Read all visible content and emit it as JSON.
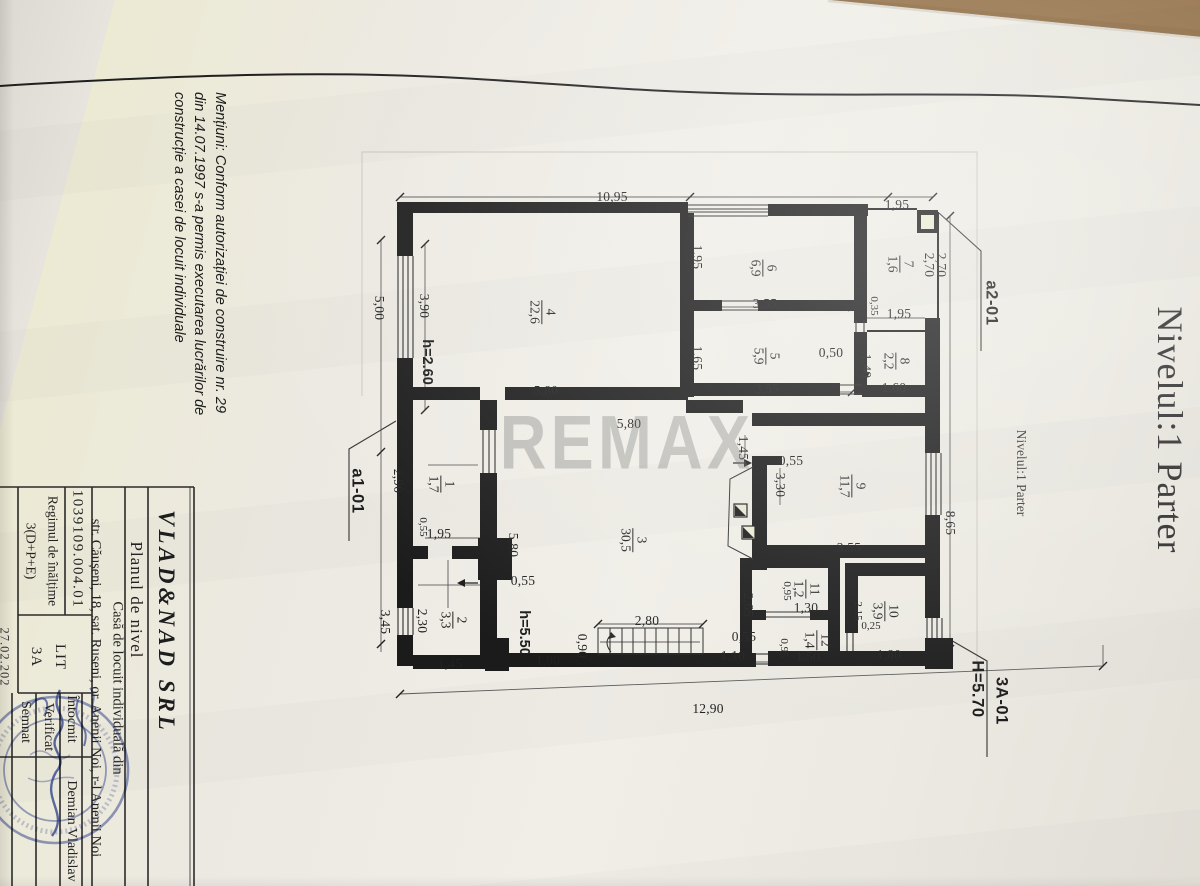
{
  "sheet": {
    "watermark": "REMAX",
    "level_title": "Nivelul:1 Parter",
    "note": "Mențiuni: Conform autorizației de construire nr. 29 din 14.07.1997 s-a permis executarea lucrărilor de construcție a casei de locuit individuale"
  },
  "title_block": {
    "company": "VLAD&NAD SRL",
    "drawing_title": "Planul de nivel",
    "object": "Casă de locuit individuală din str. Căușeni, 18, sat. Ruseni, or. Anenii Noi, r-l Anenii Noi",
    "cadastral_number": "1039109.004.01",
    "height_regime": "Regimul de înălțime 3(D+P+E)",
    "lit": "LIT 3A",
    "rows": [
      {
        "label": "Întocmit",
        "value": "Demian Vladislav"
      },
      {
        "label": "Verificat",
        "value": ""
      },
      {
        "label": "Semnat",
        "value": ""
      }
    ],
    "date_partial": "27.02.202"
  },
  "rooms": [
    {
      "no": "1",
      "area_m2": "1,7"
    },
    {
      "no": "2",
      "area_m2": "3,3"
    },
    {
      "no": "3",
      "area_m2": "30,5"
    },
    {
      "no": "4",
      "area_m2": "22,6"
    },
    {
      "no": "5",
      "area_m2": "5,9"
    },
    {
      "no": "6",
      "area_m2": "6,9"
    },
    {
      "no": "7",
      "area_m2": "1,6"
    },
    {
      "no": "8",
      "area_m2": "2,2"
    },
    {
      "no": "9",
      "area_m2": "11,7"
    },
    {
      "no": "10",
      "area_m2": "3,9"
    },
    {
      "no": "11",
      "area_m2": "1,2"
    },
    {
      "no": "12",
      "area_m2": "1,4"
    }
  ],
  "labels": [
    {
      "name": "dim-top-1095",
      "cls": "dim",
      "rot": "h",
      "x": 612,
      "y": 197,
      "text": "10,95"
    },
    {
      "name": "dim-top-195",
      "cls": "dim",
      "rot": "h",
      "x": 897,
      "y": 205,
      "text": "1,95"
    },
    {
      "name": "dim-270-a",
      "cls": "dim",
      "rot": "v",
      "x": 929,
      "y": 265,
      "text": "2,70"
    },
    {
      "name": "dim-270-b",
      "cls": "dim",
      "rot": "v",
      "x": 941,
      "y": 265,
      "text": "2,70"
    },
    {
      "name": "dim-195-room6",
      "cls": "dim",
      "rot": "v",
      "x": 697,
      "y": 257,
      "text": "1,95"
    },
    {
      "name": "dim-355-room6",
      "cls": "dim",
      "rot": "h",
      "x": 765,
      "y": 304,
      "text": "3,55"
    },
    {
      "name": "dim-035",
      "cls": "dimsm",
      "rot": "v",
      "x": 874,
      "y": 306,
      "text": "0,35"
    },
    {
      "name": "dim-195-room8",
      "cls": "dim",
      "rot": "h",
      "x": 899,
      "y": 314,
      "text": "1,95"
    },
    {
      "name": "dim-165",
      "cls": "dim",
      "rot": "v",
      "x": 697,
      "y": 358,
      "text": "1,65"
    },
    {
      "name": "dim-050",
      "cls": "dim",
      "rot": "h",
      "x": 831,
      "y": 353,
      "text": "0,50"
    },
    {
      "name": "dim-140",
      "cls": "dim",
      "rot": "v",
      "x": 866,
      "y": 366,
      "text": "1,40"
    },
    {
      "name": "dim-160",
      "cls": "dim",
      "rot": "h",
      "x": 894,
      "y": 388,
      "text": "1,60"
    },
    {
      "name": "dim-355-room5",
      "cls": "dim",
      "rot": "h",
      "x": 767,
      "y": 389,
      "text": "3,55"
    },
    {
      "name": "dim-500",
      "cls": "dim",
      "rot": "v",
      "x": 379,
      "y": 308,
      "text": "5,00"
    },
    {
      "name": "dim-390",
      "cls": "dim",
      "rot": "v",
      "x": 424,
      "y": 306,
      "text": "3,90"
    },
    {
      "name": "dim-580-a",
      "cls": "dim",
      "rot": "h",
      "x": 546,
      "y": 391,
      "text": "5,80"
    },
    {
      "name": "dim-580-b",
      "cls": "dim",
      "rot": "h",
      "x": 629,
      "y": 424,
      "text": "5,80"
    },
    {
      "name": "dim-290",
      "cls": "dim",
      "rot": "v",
      "x": 398,
      "y": 481,
      "text": "2,90"
    },
    {
      "name": "dim-145-hall",
      "cls": "dim",
      "rot": "v",
      "x": 743,
      "y": 448,
      "text": "1,45"
    },
    {
      "name": "dim-055-hall",
      "cls": "dim",
      "rot": "h",
      "x": 791,
      "y": 461,
      "text": "0,55"
    },
    {
      "name": "dim-330",
      "cls": "dim",
      "rot": "v",
      "x": 780,
      "y": 485,
      "text": "3,30"
    },
    {
      "name": "dim-865",
      "cls": "dim",
      "rot": "v",
      "x": 950,
      "y": 523,
      "text": "8,65"
    },
    {
      "name": "dim-355-room9",
      "cls": "dim",
      "rot": "h",
      "x": 849,
      "y": 548,
      "text": "3,55"
    },
    {
      "name": "dim-055-room1",
      "cls": "dimsm",
      "rot": "v",
      "x": 423,
      "y": 527,
      "text": "0,55"
    },
    {
      "name": "dim-195-room2",
      "cls": "dim",
      "rot": "h",
      "x": 439,
      "y": 534,
      "text": "1,95"
    },
    {
      "name": "dim-580-c",
      "cls": "dim",
      "rot": "v",
      "x": 513,
      "y": 545,
      "text": "5,80"
    },
    {
      "name": "dim-055-mid",
      "cls": "dim",
      "rot": "h",
      "x": 523,
      "y": 581,
      "text": "0,55"
    },
    {
      "name": "dim-230",
      "cls": "dim",
      "rot": "v",
      "x": 422,
      "y": 621,
      "text": "2,30"
    },
    {
      "name": "dim-345",
      "cls": "dim",
      "rot": "v",
      "x": 385,
      "y": 622,
      "text": "3,45"
    },
    {
      "name": "dim-265",
      "cls": "dim",
      "rot": "v",
      "x": 748,
      "y": 605,
      "text": "2,65"
    },
    {
      "name": "dim-095-room11",
      "cls": "dimsm",
      "rot": "v",
      "x": 787,
      "y": 591,
      "text": "0,95"
    },
    {
      "name": "dim-130",
      "cls": "dim",
      "rot": "h",
      "x": 806,
      "y": 608,
      "text": "1,30"
    },
    {
      "name": "dim-215",
      "cls": "dimsm",
      "rot": "v",
      "x": 858,
      "y": 611,
      "text": "2,15"
    },
    {
      "name": "dim-025",
      "cls": "dimsm",
      "rot": "h",
      "x": 871,
      "y": 626,
      "text": "0,25"
    },
    {
      "name": "dim-055-bottom",
      "cls": "dim",
      "rot": "h",
      "x": 744,
      "y": 637,
      "text": "0,55"
    },
    {
      "name": "dim-095-room12",
      "cls": "dimsm",
      "rot": "v",
      "x": 784,
      "y": 648,
      "text": "0,95"
    },
    {
      "name": "dim-150",
      "cls": "dim",
      "rot": "h",
      "x": 808,
      "y": 657,
      "text": "1,50"
    },
    {
      "name": "dim-180",
      "cls": "dim",
      "rot": "h",
      "x": 889,
      "y": 655,
      "text": "1,80"
    },
    {
      "name": "dim-145-bottom",
      "cls": "dim",
      "rot": "h",
      "x": 450,
      "y": 664,
      "text": "1,45"
    },
    {
      "name": "dim-190",
      "cls": "dim",
      "rot": "h",
      "x": 548,
      "y": 661,
      "text": "1,90"
    },
    {
      "name": "dim-090",
      "cls": "dim",
      "rot": "v",
      "x": 582,
      "y": 646,
      "text": "0,90"
    },
    {
      "name": "dim-280",
      "cls": "dim",
      "rot": "h",
      "x": 647,
      "y": 621,
      "text": "2,80"
    },
    {
      "name": "dim-110",
      "cls": "dim",
      "rot": "h",
      "x": 733,
      "y": 656,
      "text": "1,10"
    },
    {
      "name": "dim-1290",
      "cls": "dim",
      "rot": "h",
      "x": 708,
      "y": 709,
      "text": "12,90"
    },
    {
      "name": "room-label-1",
      "cls": "room",
      "rot": "v",
      "x": 441,
      "y": 484,
      "room": {
        "no": "1",
        "area": "1,7"
      }
    },
    {
      "name": "room-label-2",
      "cls": "room",
      "rot": "v",
      "x": 453,
      "y": 620,
      "room": {
        "no": "2",
        "area": "3,3"
      }
    },
    {
      "name": "room-label-3",
      "cls": "room",
      "rot": "v",
      "x": 633,
      "y": 540,
      "room": {
        "no": "3",
        "area": "30,5"
      }
    },
    {
      "name": "room-label-4",
      "cls": "room",
      "rot": "v",
      "x": 542,
      "y": 312,
      "room": {
        "no": "4",
        "area": "22,6"
      }
    },
    {
      "name": "room-label-5",
      "cls": "room",
      "rot": "v",
      "x": 766,
      "y": 356,
      "room": {
        "no": "5",
        "area": "5,9"
      }
    },
    {
      "name": "room-label-6",
      "cls": "room",
      "rot": "v",
      "x": 763,
      "y": 268,
      "room": {
        "no": "6",
        "area": "6,9"
      }
    },
    {
      "name": "room-label-7",
      "cls": "room",
      "rot": "v",
      "x": 900,
      "y": 264,
      "room": {
        "no": "7",
        "area": "1,6"
      }
    },
    {
      "name": "room-label-8",
      "cls": "room",
      "rot": "v",
      "x": 896,
      "y": 361,
      "room": {
        "no": "8",
        "area": "2,2"
      }
    },
    {
      "name": "room-label-9",
      "cls": "room",
      "rot": "v",
      "x": 852,
      "y": 486,
      "room": {
        "no": "9",
        "area": "11,7"
      }
    },
    {
      "name": "room-label-10",
      "cls": "room",
      "rot": "v",
      "x": 885,
      "y": 611,
      "room": {
        "no": "10",
        "area": "3,9"
      }
    },
    {
      "name": "room-label-11",
      "cls": "room",
      "rot": "v",
      "x": 806,
      "y": 589,
      "room": {
        "no": "11",
        "area": "1,2"
      }
    },
    {
      "name": "room-label-12",
      "cls": "room",
      "rot": "v",
      "x": 817,
      "y": 640,
      "room": {
        "no": "12",
        "area": "1,4"
      }
    },
    {
      "name": "height-label-h260",
      "cls": "bold",
      "rot": "v",
      "x": 427,
      "y": 362,
      "text": "h=2.60"
    },
    {
      "name": "height-label-h550",
      "cls": "bold",
      "rot": "v",
      "x": 524,
      "y": 633,
      "text": "h=5.50"
    },
    {
      "name": "section-label-a1-01",
      "cls": "boldlg",
      "rot": "v",
      "x": 357,
      "y": 491,
      "text": "a1-01"
    },
    {
      "name": "section-label-a2-01",
      "cls": "boldlg",
      "rot": "v",
      "x": 991,
      "y": 303,
      "text": "a2-01"
    },
    {
      "name": "section-label-3a-01",
      "cls": "boldlg",
      "rot": "v",
      "x": 1001,
      "y": 701,
      "text": "3A-01"
    },
    {
      "name": "height-label-h570",
      "cls": "boldlg",
      "rot": "v",
      "x": 977,
      "y": 689,
      "text": "H=5.70"
    },
    {
      "name": "level-title-small",
      "cls": "titlesm",
      "rot": "v",
      "x": 1021,
      "y": 473,
      "text": "Nivelul:1 Parter"
    },
    {
      "name": "level-title-large",
      "cls": "titlelg",
      "rot": "v",
      "x": 1170,
      "y": 430,
      "text": "Nivelul:1 Parter"
    },
    {
      "name": "mentiuni-note",
      "cls": "mentiuni",
      "rot": "v",
      "x": 199,
      "y": 293,
      "lines": [
        "Mențiuni: Conform autorizației de construire nr. 29",
        "din 14.07.1997 s-a permis executarea lucrărilor de",
        "construcție a casei de locuit individuale"
      ]
    },
    {
      "name": "company-name",
      "cls": "tb-company",
      "rot": "v",
      "x": 166,
      "y": 622,
      "text": "VLAD&NAD SRL"
    },
    {
      "name": "drawing-title",
      "cls": "tb-title",
      "rot": "v",
      "x": 136,
      "y": 600,
      "text": "Planul de nivel"
    },
    {
      "name": "object-address",
      "cls": "tb-casa",
      "rot": "v",
      "x": 106,
      "y": 688,
      "lines": [
        "Casă de locuit individuală din",
        "str. Căușeni, 18, sat. Ruseni, or. Anenii Noi, r-l Anenii Noi"
      ]
    },
    {
      "name": "cadastral-number",
      "cls": "tb-num",
      "rot": "v",
      "x": 77,
      "y": 549,
      "text": "1039109.004.01"
    },
    {
      "name": "height-regime-cell",
      "cls": "tb-reg",
      "rot": "v",
      "x": 42,
      "y": 551,
      "lines": [
        "Regimul de înălțime",
        "3(D+P+E)"
      ]
    },
    {
      "name": "lit-cell",
      "cls": "tb-lit",
      "rot": "v",
      "x": 48,
      "y": 657,
      "lines": [
        "LIT",
        "3A"
      ]
    },
    {
      "name": "row-intocmit",
      "cls": "tb-row",
      "rot": "v",
      "x": 71,
      "y": 719,
      "text": "Întocmit"
    },
    {
      "name": "author-name",
      "cls": "tb-row",
      "rot": "v",
      "x": 71,
      "y": 831,
      "text": "Demian Vladislav"
    },
    {
      "name": "row-verificat",
      "cls": "tb-row",
      "rot": "v",
      "x": 48,
      "y": 727,
      "text": "Verificat"
    },
    {
      "name": "row-semnat",
      "cls": "tb-row",
      "rot": "v",
      "x": 25,
      "y": 722,
      "text": "Semnat"
    },
    {
      "name": "date-partial",
      "cls": "tb-date",
      "rot": "v",
      "x": 4,
      "y": 657,
      "text": "27.02.202"
    },
    {
      "name": "watermark",
      "cls": "wm",
      "rot": "h",
      "x": 627,
      "y": 443,
      "sx": 0.85,
      "text": "REMAX"
    }
  ]
}
